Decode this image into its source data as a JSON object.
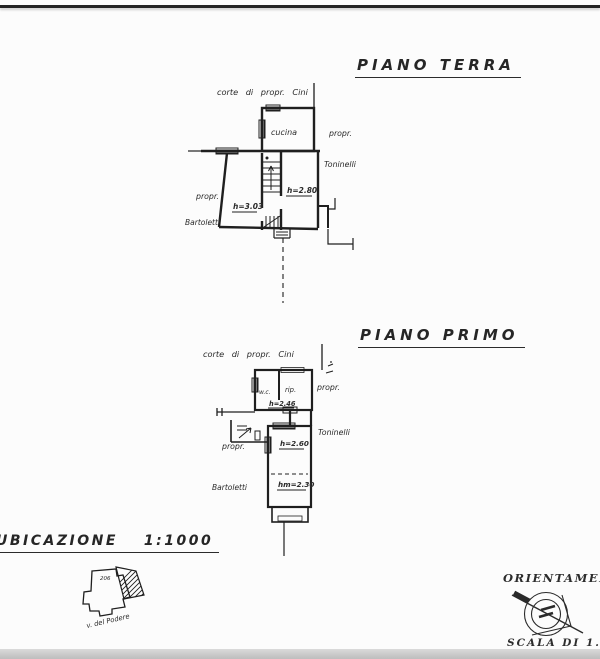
{
  "ground_floor": {
    "title": "PIANO TERRA",
    "courtyard_label": "corte di propr. Cini",
    "room_kitchen": "cucina",
    "neighbor_right_line1": "propr.",
    "neighbor_right_line2": "Toninelli",
    "neighbor_left_line1": "propr.",
    "neighbor_left_line2": "Bartoletti",
    "height_left_room": "h=3.03",
    "height_right_room": "h=2.80"
  },
  "first_floor": {
    "title": "PIANO PRIMO",
    "courtyard_label": "corte di propr. Cini",
    "room_wc": "w.c.",
    "room_rip": "rip.",
    "height_rip": "h=2.46",
    "neighbor_right_line1": "propr.",
    "neighbor_right_line2": "Toninelli",
    "neighbor_left_line1": "propr.",
    "neighbor_left_line2": "Bartoletti",
    "height_main_upper": "h=2.60",
    "height_main_lower": "hm=2.30"
  },
  "location_map": {
    "title": "UBICAZIONE",
    "scale": "1:1000",
    "parcel_number": "206",
    "street_name": "v. del Podere"
  },
  "orientation": {
    "title": "ORIENTAMENTO",
    "scale_label": "SCALA DI 1.200"
  },
  "colors": {
    "ink": "#1f1f1f",
    "paper": "#fcfcfc",
    "scan_line": "#242424",
    "scan_band": "#c7c7c7",
    "window_fill": "#9b9b9b"
  }
}
